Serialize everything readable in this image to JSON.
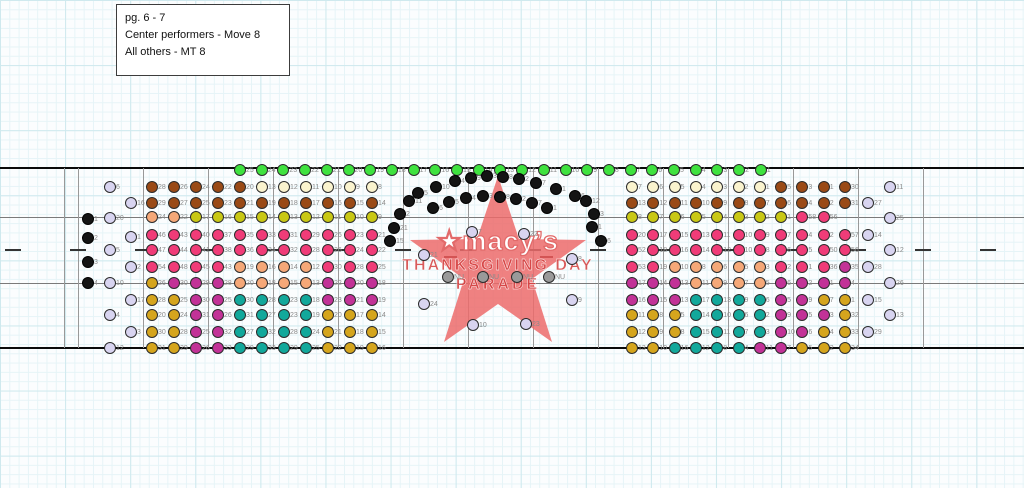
{
  "note_box": {
    "lines": [
      "pg. 6 - 7",
      "Center performers - Move 8",
      "All others - MT 8"
    ]
  },
  "logo": {
    "brand": "★macy’s",
    "line1": "THANKSGIVING DAY",
    "line2": "PARADE",
    "star_color": "#ec6b6b",
    "text_color": "#d23e3e"
  },
  "palette": {
    "bn": "#9a4a16",
    "cm": "#faf3ce",
    "yg": "#c9c815",
    "pk": "#f03c78",
    "og": "#f5a878",
    "gd": "#d5a51d",
    "mg": "#c23297",
    "tl": "#12a89b",
    "gn": "#3fe23f",
    "lv": "#d8d4f0",
    "bk": "#141414",
    "gy": "#9a9a9a"
  },
  "drill": {
    "rows": [
      {
        "y": 170,
        "x0": 240.0,
        "dx": 21.7,
        "c": [
          "gn",
          "gn",
          "gn",
          "gn",
          "gn",
          "gn",
          "gn",
          "gn",
          "gn",
          "gn",
          "gn",
          "gn",
          "gn",
          "gn",
          "gn",
          "gn",
          "gn",
          "gn",
          "gn",
          "gn",
          "gn",
          "gn",
          "gn",
          "gn",
          "gn"
        ],
        "l": [
          "25",
          "24",
          "23",
          "22",
          "21",
          "20",
          "19",
          "18",
          "17",
          "16",
          "15",
          "14",
          "13",
          "12",
          "11",
          "10",
          "9",
          "8",
          "7",
          "6",
          "5",
          "4",
          "3",
          "2",
          "1"
        ]
      },
      {
        "y": 187,
        "x0": 152,
        "dx": 22,
        "c": [
          "bn",
          "bn",
          "bn",
          "bn",
          "bn",
          "cm",
          "cm",
          "cm",
          "cm",
          "cm",
          "cm"
        ],
        "l": [
          "28",
          "26",
          "24",
          "22",
          "20",
          "13",
          "12",
          "11",
          "10",
          "9",
          "8"
        ]
      },
      {
        "y": 203,
        "x0": 152,
        "dx": 22,
        "c": [
          "bn",
          "bn",
          "bn",
          "bn",
          "bn",
          "bn",
          "bn",
          "bn",
          "bn",
          "bn",
          "bn"
        ],
        "l": [
          "29",
          "27",
          "25",
          "23",
          "21",
          "19",
          "18",
          "17",
          "16",
          "15",
          "14"
        ]
      },
      {
        "y": 217,
        "x0": 152,
        "dx": 22,
        "c": [
          "og",
          "og",
          "yg",
          "yg",
          "yg",
          "yg",
          "yg",
          "yg",
          "yg",
          "yg",
          "yg"
        ],
        "l": [
          "24",
          "22",
          "17",
          "16",
          "15",
          "14",
          "13",
          "12",
          "11",
          "10",
          "9"
        ]
      },
      {
        "y": 235,
        "x0": 152,
        "dx": 22,
        "c": [
          "pk",
          "pk",
          "pk",
          "pk",
          "pk",
          "pk",
          "pk",
          "pk",
          "pk",
          "pk",
          "pk"
        ],
        "l": [
          "46",
          "43",
          "40",
          "37",
          "35",
          "33",
          "31",
          "29",
          "26",
          "23",
          "21"
        ]
      },
      {
        "y": 250,
        "x0": 152,
        "dx": 22,
        "c": [
          "pk",
          "pk",
          "pk",
          "pk",
          "pk",
          "pk",
          "pk",
          "pk",
          "pk",
          "pk",
          "pk"
        ],
        "l": [
          "47",
          "44",
          "41",
          "38",
          "36",
          "34",
          "32",
          "28",
          "26",
          "24",
          "22"
        ]
      },
      {
        "y": 267,
        "x0": 152,
        "dx": 22,
        "c": [
          "pk",
          "pk",
          "pk",
          "pk",
          "og",
          "og",
          "og",
          "og",
          "pk",
          "pk",
          "pk"
        ],
        "l": [
          "54",
          "48",
          "45",
          "43",
          "19",
          "16",
          "14",
          "12",
          "30",
          "28",
          "25"
        ]
      },
      {
        "y": 283,
        "x0": 152,
        "dx": 22,
        "c": [
          "gd",
          "mg",
          "mg",
          "mg",
          "og",
          "og",
          "og",
          "og",
          "mg",
          "mg",
          "mg"
        ],
        "l": [
          "26",
          "30",
          "29",
          "28",
          "20",
          "18",
          "15",
          "13",
          "22",
          "20",
          "18"
        ]
      },
      {
        "y": 300,
        "x0": 152,
        "dx": 22,
        "c": [
          "gd",
          "gd",
          "mg",
          "mg",
          "tl",
          "tl",
          "tl",
          "tl",
          "mg",
          "mg",
          "mg"
        ],
        "l": [
          "28",
          "25",
          "30",
          "25",
          "30",
          "28",
          "23",
          "18",
          "23",
          "21",
          "19"
        ]
      },
      {
        "y": 315,
        "x0": 152,
        "dx": 22,
        "c": [
          "gd",
          "gd",
          "mg",
          "mg",
          "tl",
          "tl",
          "tl",
          "tl",
          "gd",
          "gd",
          "gd"
        ],
        "l": [
          "20",
          "24",
          "31",
          "26",
          "31",
          "27",
          "23",
          "19",
          "20",
          "17",
          "14"
        ]
      },
      {
        "y": 332,
        "x0": 152,
        "dx": 22,
        "c": [
          "gd",
          "gd",
          "mg",
          "mg",
          "tl",
          "tl",
          "tl",
          "tl",
          "gd",
          "gd",
          "gd"
        ],
        "l": [
          "30",
          "28",
          "25",
          "32",
          "27",
          "32",
          "28",
          "24",
          "21",
          "18",
          "15"
        ]
      },
      {
        "y": 348,
        "x0": 152,
        "dx": 22,
        "c": [
          "gd",
          "gd",
          "mg",
          "mg",
          "tl",
          "tl",
          "tl",
          "tl",
          "gd",
          "gd",
          "gd"
        ],
        "l": [
          "31",
          "29",
          "26",
          "33",
          "29",
          "33",
          "29",
          "25",
          "22",
          "19",
          "16"
        ]
      },
      {
        "y": 187,
        "x0": 632,
        "dx": 21.3,
        "c": [
          "cm",
          "cm",
          "cm",
          "cm",
          "cm",
          "cm",
          "cm",
          "bn",
          "bn",
          "bn",
          "bn"
        ],
        "l": [
          "7",
          "6",
          "5",
          "4",
          "3",
          "2",
          "1",
          "5",
          "3",
          "1",
          "30"
        ]
      },
      {
        "y": 203,
        "x0": 632,
        "dx": 21.3,
        "c": [
          "bn",
          "bn",
          "bn",
          "bn",
          "bn",
          "bn",
          "bn",
          "bn",
          "bn",
          "bn",
          "bn"
        ],
        "l": [
          "13",
          "12",
          "11",
          "10",
          "9",
          "8",
          "7",
          "6",
          "4",
          "2",
          "31"
        ]
      },
      {
        "y": 217,
        "x0": 632,
        "dx": 21.3,
        "c": [
          "yg",
          "yg",
          "yg",
          "yg",
          "yg",
          "yg",
          "yg",
          "yg",
          "pk",
          "pk",
          null
        ],
        "l": [
          "8",
          "7",
          "6",
          "5",
          "4",
          "3",
          "2",
          "1",
          "58",
          "56",
          ""
        ]
      },
      {
        "y": 235,
        "x0": 632,
        "dx": 21.3,
        "c": [
          "pk",
          "pk",
          "pk",
          "pk",
          "pk",
          "pk",
          "pk",
          "pk",
          "pk",
          "pk",
          "pk"
        ],
        "l": [
          "20",
          "17",
          "15",
          "13",
          "11",
          "10",
          "9",
          "7",
          "4",
          "2",
          "57"
        ]
      },
      {
        "y": 250,
        "x0": 632,
        "dx": 21.3,
        "c": [
          "pk",
          "pk",
          "pk",
          "pk",
          "pk",
          "pk",
          "pk",
          "pk",
          "pk",
          "pk",
          "pk"
        ],
        "l": [
          "52",
          "18",
          "16",
          "14",
          "12",
          "10",
          "8",
          "6",
          "5",
          "50",
          "56"
        ]
      },
      {
        "y": 267,
        "x0": 632,
        "dx": 21.3,
        "c": [
          "pk",
          "pk",
          "og",
          "og",
          "og",
          "og",
          "og",
          "pk",
          "pk",
          "pk",
          "mg"
        ],
        "l": [
          "53",
          "19",
          "10",
          "8",
          "6",
          "5",
          "3",
          "2",
          "1",
          "36",
          "35"
        ]
      },
      {
        "y": 283,
        "x0": 632,
        "dx": 21.3,
        "c": [
          "mg",
          "mg",
          "mg",
          "og",
          "og",
          "og",
          "og",
          "mg",
          "mg",
          "mg",
          "mg"
        ],
        "l": [
          "17",
          "14",
          "13",
          "11",
          "9",
          "7",
          "5",
          "6",
          "2",
          "1",
          "4"
        ]
      },
      {
        "y": 300,
        "x0": 632,
        "dx": 21.3,
        "c": [
          "mg",
          "mg",
          "mg",
          "tl",
          "tl",
          "tl",
          "tl",
          "mg",
          "mg",
          "gd",
          "gd"
        ],
        "l": [
          "16",
          "15",
          "13",
          "17",
          "13",
          "9",
          "6",
          "5",
          "9",
          "7",
          "1"
        ]
      },
      {
        "y": 315,
        "x0": 632,
        "dx": 21.3,
        "c": [
          "gd",
          "gd",
          "gd",
          "tl",
          "tl",
          "tl",
          "tl",
          "mg",
          "mg",
          "mg",
          "gd"
        ],
        "l": [
          "11",
          "8",
          "5",
          "14",
          "10",
          "6",
          "2",
          "9",
          "5",
          "3",
          "32"
        ]
      },
      {
        "y": 332,
        "x0": 632,
        "dx": 21.3,
        "c": [
          "gd",
          "gd",
          "gd",
          "tl",
          "tl",
          "tl",
          "tl",
          "mg",
          "mg",
          "gd",
          "gd"
        ],
        "l": [
          "12",
          "9",
          "8",
          "15",
          "11",
          "7",
          "3",
          "10",
          "6",
          "4",
          "33"
        ]
      },
      {
        "y": 348,
        "x0": 632,
        "dx": 21.3,
        "c": [
          "gd",
          "gd",
          "tl",
          "tl",
          "tl",
          "tl",
          "mg",
          "mg",
          "gd",
          "gd",
          "gd"
        ],
        "l": [
          "13",
          "10",
          "16",
          "12",
          "8",
          "4",
          "11",
          "7",
          "5",
          "2",
          "34"
        ]
      }
    ],
    "singles": [
      {
        "x": 88,
        "y": 219,
        "c": "bk",
        "l": "1"
      },
      {
        "x": 88,
        "y": 238,
        "c": "bk",
        "l": "2"
      },
      {
        "x": 88,
        "y": 262,
        "c": "bk",
        "l": "3"
      },
      {
        "x": 88,
        "y": 283,
        "c": "bk",
        "l": "4"
      },
      {
        "x": 110,
        "y": 187,
        "c": "lv",
        "l": "6"
      },
      {
        "x": 110,
        "y": 218,
        "c": "lv",
        "l": "20"
      },
      {
        "x": 110,
        "y": 250,
        "c": "lv",
        "l": "5"
      },
      {
        "x": 110,
        "y": 283,
        "c": "lv",
        "l": "10"
      },
      {
        "x": 110,
        "y": 315,
        "c": "lv",
        "l": "4"
      },
      {
        "x": 110,
        "y": 348,
        "c": "lv",
        "l": "12"
      },
      {
        "x": 131,
        "y": 203,
        "c": "lv",
        "l": "16"
      },
      {
        "x": 131,
        "y": 237,
        "c": "lv",
        "l": "1"
      },
      {
        "x": 131,
        "y": 267,
        "c": "lv",
        "l": "2"
      },
      {
        "x": 131,
        "y": 300,
        "c": "lv",
        "l": "17"
      },
      {
        "x": 131,
        "y": 332,
        "c": "lv",
        "l": "3"
      },
      {
        "x": 868,
        "y": 203,
        "c": "lv",
        "l": "27"
      },
      {
        "x": 868,
        "y": 235,
        "c": "lv",
        "l": "14"
      },
      {
        "x": 868,
        "y": 267,
        "c": "lv",
        "l": "28"
      },
      {
        "x": 868,
        "y": 300,
        "c": "lv",
        "l": "15"
      },
      {
        "x": 868,
        "y": 332,
        "c": "lv",
        "l": "29"
      },
      {
        "x": 890,
        "y": 187,
        "c": "lv",
        "l": "11"
      },
      {
        "x": 890,
        "y": 218,
        "c": "lv",
        "l": "25"
      },
      {
        "x": 890,
        "y": 250,
        "c": "lv",
        "l": "12"
      },
      {
        "x": 890,
        "y": 283,
        "c": "lv",
        "l": "26"
      },
      {
        "x": 890,
        "y": 315,
        "c": "lv",
        "l": "13"
      },
      {
        "x": 472,
        "y": 232,
        "c": "lv",
        "l": "7"
      },
      {
        "x": 524,
        "y": 234,
        "c": "lv",
        "l": "22"
      },
      {
        "x": 424,
        "y": 255,
        "c": "lv",
        "l": "21"
      },
      {
        "x": 572,
        "y": 259,
        "c": "lv",
        "l": "8"
      },
      {
        "x": 424,
        "y": 304,
        "c": "lv",
        "l": "24"
      },
      {
        "x": 572,
        "y": 300,
        "c": "lv",
        "l": "9"
      },
      {
        "x": 473,
        "y": 325,
        "c": "lv",
        "l": "10"
      },
      {
        "x": 526,
        "y": 324,
        "c": "lv",
        "l": "23"
      },
      {
        "x": 448,
        "y": 277,
        "c": "gy",
        "l": "NU"
      },
      {
        "x": 483,
        "y": 277,
        "c": "gy",
        "l": "NU"
      },
      {
        "x": 517,
        "y": 277,
        "c": "gy",
        "l": "NU"
      },
      {
        "x": 549,
        "y": 277,
        "c": "gy",
        "l": "NU"
      },
      {
        "x": 418,
        "y": 193,
        "c": "bk",
        "l": "5"
      },
      {
        "x": 436,
        "y": 187,
        "c": "bk",
        "l": "10"
      },
      {
        "x": 455,
        "y": 181,
        "c": "bk",
        "l": "4"
      },
      {
        "x": 471,
        "y": 178,
        "c": "bk",
        "l": "9"
      },
      {
        "x": 487,
        "y": 176,
        "c": "bk",
        "l": "3"
      },
      {
        "x": 503,
        "y": 177,
        "c": "bk",
        "l": "8"
      },
      {
        "x": 519,
        "y": 179,
        "c": "bk",
        "l": "2"
      },
      {
        "x": 536,
        "y": 183,
        "c": "bk",
        "l": "7"
      },
      {
        "x": 556,
        "y": 189,
        "c": "bk",
        "l": "1"
      },
      {
        "x": 575,
        "y": 196,
        "c": "bk",
        "l": "6"
      },
      {
        "x": 433,
        "y": 208,
        "c": "bk",
        "l": "6"
      },
      {
        "x": 449,
        "y": 202,
        "c": "bk",
        "l": "5"
      },
      {
        "x": 466,
        "y": 198,
        "c": "bk",
        "l": "4"
      },
      {
        "x": 483,
        "y": 196,
        "c": "bk",
        "l": "3"
      },
      {
        "x": 500,
        "y": 197,
        "c": "bk",
        "l": "8"
      },
      {
        "x": 516,
        "y": 199,
        "c": "bk",
        "l": "2"
      },
      {
        "x": 532,
        "y": 203,
        "c": "bk",
        "l": "7"
      },
      {
        "x": 547,
        "y": 208,
        "c": "bk",
        "l": "1"
      },
      {
        "x": 409,
        "y": 201,
        "c": "bk",
        "l": "11"
      },
      {
        "x": 400,
        "y": 214,
        "c": "bk",
        "l": "2"
      },
      {
        "x": 394,
        "y": 228,
        "c": "bk",
        "l": "21"
      },
      {
        "x": 390,
        "y": 241,
        "c": "bk",
        "l": "15"
      },
      {
        "x": 586,
        "y": 201,
        "c": "bk",
        "l": "12"
      },
      {
        "x": 594,
        "y": 214,
        "c": "bk",
        "l": "3"
      },
      {
        "x": 592,
        "y": 227,
        "c": "bk",
        "l": "1"
      },
      {
        "x": 601,
        "y": 241,
        "c": "bk",
        "l": "6"
      }
    ]
  },
  "field": {
    "top_line_y": 167,
    "bottom_line_y": 347,
    "mid_line_ys": [
      217,
      283
    ],
    "vertical_line_xs": [
      64,
      78,
      143,
      208,
      273,
      338,
      403,
      468,
      533,
      598,
      663,
      728,
      793,
      858,
      923
    ],
    "hash_y": 249,
    "hash_xs": [
      13,
      78,
      143,
      208,
      273,
      338,
      403,
      468,
      533,
      598,
      663,
      728,
      793,
      858,
      923,
      988
    ]
  }
}
